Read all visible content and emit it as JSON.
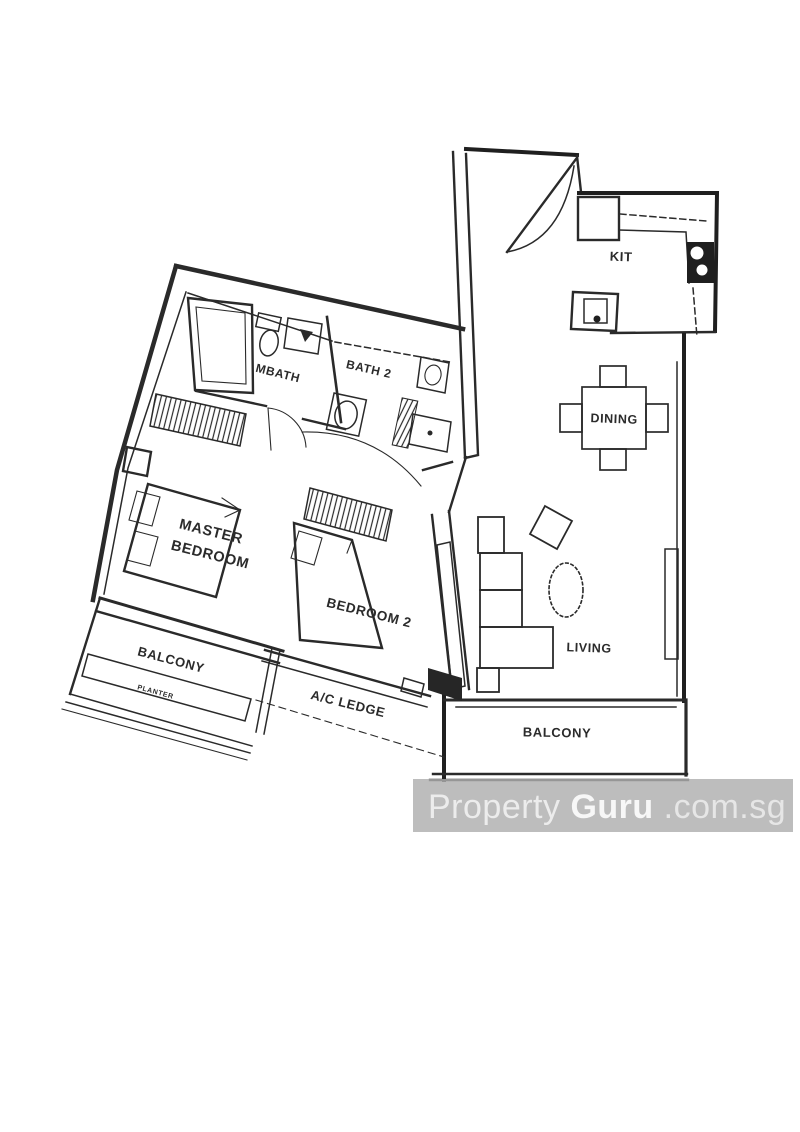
{
  "labels": {
    "kitchen": "KIT",
    "dining": "DINING",
    "living": "LIVING",
    "master_line1": "MASTER",
    "master_line2": "BEDROOM",
    "bedroom2": "BEDROOM 2",
    "mbath": "MBATH",
    "bath2": "BATH 2",
    "balcony_left": "BALCONY",
    "balcony_bottom": "BALCONY",
    "planter": "PLANTER",
    "ac_ledge": "A/C LEDGE"
  },
  "watermark": {
    "property": "Property",
    "guru": "Guru",
    "suffix": ".com.sg"
  },
  "colors": {
    "ink": "#2a2a2a",
    "paper": "#ffffff",
    "watermark_band": "#aeaeae",
    "watermark_text_light": "#ececec",
    "watermark_text_bold": "#f7f7f7"
  }
}
